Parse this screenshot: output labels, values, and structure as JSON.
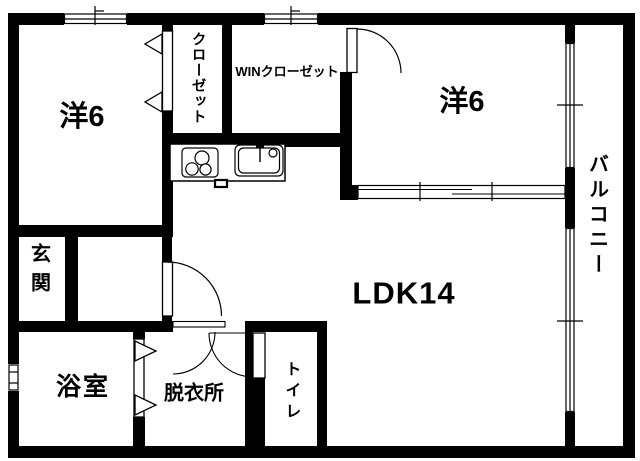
{
  "meta": {
    "type": "apartment-floorplan"
  },
  "colors": {
    "wall": "#000000",
    "floor": "#ffffff"
  },
  "rooms": {
    "western_room_left": {
      "label": "洋6"
    },
    "western_room_right": {
      "label": "洋6"
    },
    "closet": {
      "label": "クローゼット"
    },
    "walk_in_closet": {
      "label": "WINクローゼット"
    },
    "living_dining_kitchen": {
      "label": "LDK14"
    },
    "balcony": {
      "label": "バルコニー"
    },
    "entrance": {
      "label": "玄関"
    },
    "bathroom": {
      "label": "浴室"
    },
    "dressing_room": {
      "label": "脱衣所"
    },
    "toilet": {
      "label": "トイレ"
    }
  }
}
